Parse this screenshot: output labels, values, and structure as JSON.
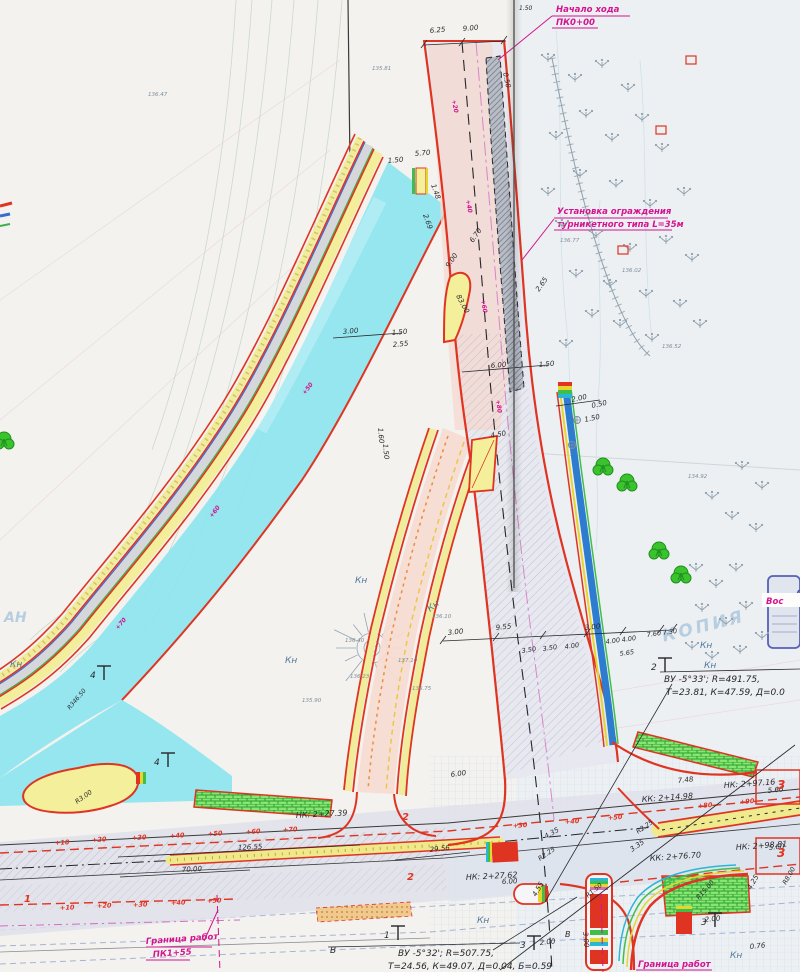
{
  "document": {
    "kind": "road construction plan scan",
    "watermark": "КОПИЯ",
    "corner_mark": "АН"
  },
  "callouts": {
    "start": {
      "line1": "Начало хода",
      "line2": "ПК0+00"
    },
    "fence": {
      "line1": "Установка ограждения",
      "line2": "турникетного типа L=35м"
    },
    "boundary_left": {
      "line1": "Граница работ",
      "line2": "ПК1+55"
    },
    "boundary_right": {
      "line1": "Граница работ"
    },
    "vos": "Вос"
  },
  "curves": {
    "c1": {
      "line1": "ВУ -5°33'; R=491.75,",
      "line2": "Т=23.81, К=47.59, Д=0.0"
    },
    "c2": {
      "line1": "ВУ -5°32'; R=507.75,",
      "line2": "Т=24.56, К=49.07, Д=0.04, Б=0.59"
    }
  },
  "colors": {
    "curb_red": "#e03422",
    "magenta": "#d4148f",
    "cyan_road": "#8ce4ef",
    "yellow_walk": "#f2ee9b",
    "drain_blue": "#2e7cd0",
    "lawn_green": "#86e573"
  },
  "labels": [
    {
      "t": "НК: 2+27.39",
      "x": 296,
      "y": 818,
      "r": -3,
      "c": "k",
      "s": 8,
      "n": "station-label"
    },
    {
      "t": "НК: 2+27.62",
      "x": 466,
      "y": 880,
      "r": -3,
      "c": "k",
      "s": 8,
      "n": "station-label"
    },
    {
      "t": "КК: 2+14.98",
      "x": 642,
      "y": 802,
      "r": -4,
      "c": "k",
      "s": 8,
      "n": "station-label"
    },
    {
      "t": "НК: 2+97.16",
      "x": 724,
      "y": 788,
      "r": -4,
      "c": "k",
      "s": 8,
      "n": "station-label"
    },
    {
      "t": "НК: 2+98.81",
      "x": 736,
      "y": 850,
      "r": -4,
      "c": "k",
      "s": 8,
      "n": "station-label"
    },
    {
      "t": "КК: 2+76.70",
      "x": 650,
      "y": 861,
      "r": -4,
      "c": "k",
      "s": 8,
      "n": "station-label"
    },
    {
      "t": "6.25",
      "x": 430,
      "y": 33,
      "r": -5,
      "c": "k",
      "s": 7
    },
    {
      "t": "9.00",
      "x": 463,
      "y": 31,
      "r": -5,
      "c": "k",
      "s": 7
    },
    {
      "t": "0.50",
      "x": 503,
      "y": 73,
      "r": 78,
      "c": "k",
      "s": 7
    },
    {
      "t": "1.50",
      "x": 519,
      "y": 10,
      "r": 0,
      "c": "k",
      "s": 6
    },
    {
      "t": "5.70",
      "x": 415,
      "y": 156,
      "r": -5,
      "c": "k",
      "s": 7
    },
    {
      "t": "1.50",
      "x": 388,
      "y": 163,
      "r": -5,
      "c": "k",
      "s": 7
    },
    {
      "t": "1.48",
      "x": 431,
      "y": 185,
      "r": 70,
      "c": "k",
      "s": 7
    },
    {
      "t": "2.69",
      "x": 423,
      "y": 215,
      "r": 70,
      "c": "k",
      "s": 7
    },
    {
      "t": "6.70",
      "x": 473,
      "y": 243,
      "r": -55,
      "c": "k",
      "s": 7
    },
    {
      "t": "9.00",
      "x": 449,
      "y": 268,
      "r": -55,
      "c": "k",
      "s": 7
    },
    {
      "t": "83.00",
      "x": 456,
      "y": 296,
      "r": 62,
      "c": "k",
      "s": 7
    },
    {
      "t": "2.65",
      "x": 539,
      "y": 292,
      "r": -55,
      "c": "k",
      "s": 7
    },
    {
      "t": "6.00",
      "x": 491,
      "y": 368,
      "r": -5,
      "c": "k",
      "s": 7
    },
    {
      "t": "1.50",
      "x": 539,
      "y": 367,
      "r": -5,
      "c": "k",
      "s": 7
    },
    {
      "t": "3.00",
      "x": 343,
      "y": 334,
      "r": -5,
      "c": "k",
      "s": 7
    },
    {
      "t": "1.50",
      "x": 392,
      "y": 335,
      "r": -5,
      "c": "k",
      "s": 7
    },
    {
      "t": "2.55",
      "x": 393,
      "y": 347,
      "r": -5,
      "c": "k",
      "s": 7
    },
    {
      "t": "2.00",
      "x": 572,
      "y": 402,
      "r": -12,
      "c": "k",
      "s": 7
    },
    {
      "t": "0.50",
      "x": 592,
      "y": 408,
      "r": -12,
      "c": "k",
      "s": 7
    },
    {
      "t": "1.50",
      "x": 585,
      "y": 422,
      "r": -12,
      "c": "k",
      "s": 7
    },
    {
      "t": "1.60",
      "x": 378,
      "y": 428,
      "r": 85,
      "c": "k",
      "s": 7
    },
    {
      "t": "1.50",
      "x": 383,
      "y": 444,
      "r": 85,
      "c": "k",
      "s": 7
    },
    {
      "t": "4.50",
      "x": 491,
      "y": 438,
      "r": -10,
      "c": "k",
      "s": 7
    },
    {
      "t": "3.00",
      "x": 448,
      "y": 635,
      "r": -6,
      "c": "k",
      "s": 7
    },
    {
      "t": "9.55",
      "x": 496,
      "y": 630,
      "r": -6,
      "c": "k",
      "s": 7
    },
    {
      "t": "3.00",
      "x": 585,
      "y": 630,
      "r": -6,
      "c": "k",
      "s": 7
    },
    {
      "t": "3.50",
      "x": 522,
      "y": 653,
      "r": -8,
      "c": "k",
      "s": 6.5
    },
    {
      "t": "3.50",
      "x": 543,
      "y": 651,
      "r": -8,
      "c": "k",
      "s": 6.5
    },
    {
      "t": "4.00",
      "x": 565,
      "y": 649,
      "r": -8,
      "c": "k",
      "s": 6.5
    },
    {
      "t": "4.00",
      "x": 606,
      "y": 644,
      "r": -8,
      "c": "k",
      "s": 6.5
    },
    {
      "t": "4.00",
      "x": 622,
      "y": 642,
      "r": -8,
      "c": "k",
      "s": 6.5
    },
    {
      "t": "7.60",
      "x": 647,
      "y": 637,
      "r": -8,
      "c": "k",
      "s": 6.5
    },
    {
      "t": "7.50",
      "x": 663,
      "y": 635,
      "r": -8,
      "c": "k",
      "s": 6.5
    },
    {
      "t": "5.65",
      "x": 620,
      "y": 656,
      "r": -8,
      "c": "k",
      "s": 6.5
    },
    {
      "t": "6.00",
      "x": 451,
      "y": 777,
      "r": -8,
      "c": "k",
      "s": 7
    },
    {
      "t": "126.55",
      "x": 238,
      "y": 850,
      "r": -3,
      "c": "k",
      "s": 7
    },
    {
      "t": "70.00",
      "x": 182,
      "y": 872,
      "r": -3,
      "c": "k",
      "s": 7
    },
    {
      "t": "29.56",
      "x": 430,
      "y": 852,
      "r": -6,
      "c": "k",
      "s": 7
    },
    {
      "t": "6.00",
      "x": 502,
      "y": 884,
      "r": -3,
      "c": "k",
      "s": 7
    },
    {
      "t": "4.35",
      "x": 546,
      "y": 839,
      "r": -30,
      "c": "k",
      "s": 7
    },
    {
      "t": "R2.25",
      "x": 540,
      "y": 861,
      "r": -35,
      "c": "k",
      "s": 6.5
    },
    {
      "t": "3.35",
      "x": 632,
      "y": 852,
      "r": -35,
      "c": "k",
      "s": 7
    },
    {
      "t": "R2.25",
      "x": 638,
      "y": 834,
      "r": -35,
      "c": "k",
      "s": 6.5
    },
    {
      "t": "7.48",
      "x": 678,
      "y": 783,
      "r": -6,
      "c": "k",
      "s": 7
    },
    {
      "t": "5.60",
      "x": 768,
      "y": 793,
      "r": -6,
      "c": "k",
      "s": 7
    },
    {
      "t": "5.60",
      "x": 769,
      "y": 850,
      "r": -6,
      "c": "k",
      "s": 7
    },
    {
      "t": "4.25",
      "x": 751,
      "y": 890,
      "r": -60,
      "c": "k",
      "s": 7
    },
    {
      "t": "R8.00",
      "x": 786,
      "y": 885,
      "r": -60,
      "c": "k",
      "s": 6.5
    },
    {
      "t": "2.00",
      "x": 705,
      "y": 922,
      "r": -6,
      "c": "k",
      "s": 7
    },
    {
      "t": "0.76",
      "x": 750,
      "y": 949,
      "r": -6,
      "c": "k",
      "s": 7
    },
    {
      "t": "R15.00",
      "x": 699,
      "y": 900,
      "r": -48,
      "c": "k",
      "s": 6.5
    },
    {
      "t": "R1.50",
      "x": 588,
      "y": 898,
      "r": -40,
      "c": "k",
      "s": 6.5
    },
    {
      "t": "4.55",
      "x": 536,
      "y": 897,
      "r": -60,
      "c": "k",
      "s": 7
    },
    {
      "t": "3.00",
      "x": 583,
      "y": 932,
      "r": 85,
      "c": "k",
      "s": 7
    },
    {
      "t": "2.00",
      "x": 540,
      "y": 945,
      "r": -6,
      "c": "k",
      "s": 7
    },
    {
      "t": "R3.00",
      "x": 77,
      "y": 804,
      "r": -35,
      "c": "k",
      "s": 6.5
    },
    {
      "t": "R346.50",
      "x": 70,
      "y": 710,
      "r": -50,
      "c": "k",
      "s": 6
    },
    {
      "t": "В",
      "x": 330,
      "y": 953,
      "r": 0,
      "c": "k",
      "s": 9
    },
    {
      "t": "В",
      "x": 565,
      "y": 937,
      "r": 0,
      "c": "k",
      "s": 8
    },
    {
      "t": "Кн",
      "x": 10,
      "y": 667,
      "r": 0,
      "c": "b",
      "s": 9,
      "n": "kn-label"
    },
    {
      "t": "Кн",
      "x": 285,
      "y": 663,
      "r": 0,
      "c": "b",
      "s": 9,
      "n": "kn-label"
    },
    {
      "t": "Кн",
      "x": 355,
      "y": 583,
      "r": 0,
      "c": "b",
      "s": 9,
      "n": "kn-label"
    },
    {
      "t": "Кн",
      "x": 430,
      "y": 612,
      "r": -38,
      "c": "b",
      "s": 9,
      "n": "kn-label"
    },
    {
      "t": "Кн",
      "x": 700,
      "y": 648,
      "r": 0,
      "c": "b",
      "s": 9,
      "n": "kn-label"
    },
    {
      "t": "Кн",
      "x": 704,
      "y": 668,
      "r": 0,
      "c": "b",
      "s": 9,
      "n": "kn-label"
    },
    {
      "t": "Кн",
      "x": 477,
      "y": 923,
      "r": 0,
      "c": "b",
      "s": 9,
      "n": "kn-label"
    },
    {
      "t": "Кн",
      "x": 730,
      "y": 958,
      "r": 0,
      "c": "b",
      "s": 9,
      "n": "kn-label"
    },
    {
      "t": "+10",
      "x": 55,
      "y": 845,
      "r": -3,
      "c": "r",
      "s": 6.5
    },
    {
      "t": "+20",
      "x": 92,
      "y": 842,
      "r": -3,
      "c": "r",
      "s": 6.5
    },
    {
      "t": "+30",
      "x": 132,
      "y": 840,
      "r": -3,
      "c": "r",
      "s": 6.5
    },
    {
      "t": "+40",
      "x": 170,
      "y": 838,
      "r": -3,
      "c": "r",
      "s": 6.5
    },
    {
      "t": "+50",
      "x": 208,
      "y": 836,
      "r": -3,
      "c": "r",
      "s": 6.5
    },
    {
      "t": "+60",
      "x": 246,
      "y": 834,
      "r": -3,
      "c": "r",
      "s": 6.5
    },
    {
      "t": "+70",
      "x": 283,
      "y": 832,
      "r": -3,
      "c": "r",
      "s": 6.5
    },
    {
      "t": "+30",
      "x": 513,
      "y": 828,
      "r": -4,
      "c": "r",
      "s": 6.5
    },
    {
      "t": "+40",
      "x": 565,
      "y": 824,
      "r": -4,
      "c": "r",
      "s": 6.5
    },
    {
      "t": "+50",
      "x": 608,
      "y": 820,
      "r": -4,
      "c": "r",
      "s": 6.5
    },
    {
      "t": "+80",
      "x": 698,
      "y": 808,
      "r": -4,
      "c": "r",
      "s": 6.5
    },
    {
      "t": "+90",
      "x": 740,
      "y": 804,
      "r": -4,
      "c": "r",
      "s": 6.5
    },
    {
      "t": "+10",
      "x": 60,
      "y": 910,
      "r": -2,
      "c": "r",
      "s": 6.5
    },
    {
      "t": "+20",
      "x": 97,
      "y": 908,
      "r": -2,
      "c": "r",
      "s": 6.5
    },
    {
      "t": "+30",
      "x": 133,
      "y": 907,
      "r": -2,
      "c": "r",
      "s": 6.5
    },
    {
      "t": "+40",
      "x": 171,
      "y": 905,
      "r": -2,
      "c": "r",
      "s": 6.5
    },
    {
      "t": "+50",
      "x": 207,
      "y": 903,
      "r": -2,
      "c": "r",
      "s": 6.5
    },
    {
      "t": "1",
      "x": 24,
      "y": 902,
      "r": 0,
      "c": "r",
      "s": 10,
      "n": "zone-number"
    },
    {
      "t": "2",
      "x": 402,
      "y": 820,
      "r": 0,
      "c": "r",
      "s": 10,
      "n": "zone-number"
    },
    {
      "t": "2",
      "x": 407,
      "y": 880,
      "r": 0,
      "c": "r",
      "s": 10,
      "n": "zone-number"
    },
    {
      "t": "3",
      "x": 777,
      "y": 789,
      "r": 0,
      "c": "r",
      "s": 12,
      "n": "zone-number"
    },
    {
      "t": "3",
      "x": 777,
      "y": 857,
      "r": 0,
      "c": "r",
      "s": 12,
      "n": "zone-number"
    },
    {
      "t": "+20",
      "x": 452,
      "y": 100,
      "r": 80,
      "c": "m",
      "s": 6
    },
    {
      "t": "+40",
      "x": 466,
      "y": 200,
      "r": 80,
      "c": "m",
      "s": 6
    },
    {
      "t": "+60",
      "x": 481,
      "y": 300,
      "r": 80,
      "c": "m",
      "s": 6
    },
    {
      "t": "+80",
      "x": 496,
      "y": 400,
      "r": 82,
      "c": "m",
      "s": 6
    },
    {
      "t": "+50",
      "x": 305,
      "y": 395,
      "r": -52,
      "c": "m",
      "s": 6
    },
    {
      "t": "+60",
      "x": 212,
      "y": 518,
      "r": -52,
      "c": "m",
      "s": 6
    },
    {
      "t": "+70",
      "x": 118,
      "y": 630,
      "r": -50,
      "c": "m",
      "s": 6
    },
    {
      "t": "136.47",
      "x": 148,
      "y": 96,
      "r": 0,
      "c": "g",
      "s": 5.5,
      "n": "elevation-label"
    },
    {
      "t": "135.81",
      "x": 372,
      "y": 70,
      "r": 0,
      "c": "g",
      "s": 5.5,
      "n": "elevation-label"
    },
    {
      "t": "136.77",
      "x": 560,
      "y": 242,
      "r": 0,
      "c": "g",
      "s": 5.5,
      "n": "elevation-label"
    },
    {
      "t": "136.02",
      "x": 622,
      "y": 272,
      "r": 0,
      "c": "g",
      "s": 5.5,
      "n": "elevation-label"
    },
    {
      "t": "136.52",
      "x": 662,
      "y": 348,
      "r": 0,
      "c": "g",
      "s": 5.5,
      "n": "elevation-label"
    },
    {
      "t": "134.92",
      "x": 688,
      "y": 478,
      "r": 0,
      "c": "g",
      "s": 5.5,
      "n": "elevation-label"
    },
    {
      "t": "136.40",
      "x": 345,
      "y": 642,
      "r": 0,
      "c": "g",
      "s": 5.5,
      "n": "elevation-label"
    },
    {
      "t": "137.10",
      "x": 398,
      "y": 662,
      "r": 0,
      "c": "g",
      "s": 5.5,
      "n": "elevation-label"
    },
    {
      "t": "136.75",
      "x": 412,
      "y": 690,
      "r": 0,
      "c": "g",
      "s": 5.5,
      "n": "elevation-label"
    },
    {
      "t": "135.90",
      "x": 302,
      "y": 702,
      "r": 0,
      "c": "g",
      "s": 5.5,
      "n": "elevation-label"
    },
    {
      "t": "136.10",
      "x": 432,
      "y": 618,
      "r": 0,
      "c": "g",
      "s": 5.5,
      "n": "elevation-label"
    },
    {
      "t": "136.23",
      "x": 350,
      "y": 678,
      "r": 0,
      "c": "g",
      "s": 5.5,
      "n": "elevation-label"
    }
  ],
  "flags": [
    {
      "n": "1",
      "x": 388,
      "y": 940
    },
    {
      "n": "2",
      "x": 655,
      "y": 672
    },
    {
      "n": "3",
      "x": 705,
      "y": 927
    },
    {
      "n": "3",
      "x": 524,
      "y": 950
    },
    {
      "n": "4",
      "x": 94,
      "y": 680
    },
    {
      "n": "4",
      "x": 158,
      "y": 767
    }
  ],
  "trees": [
    {
      "x": 603,
      "y": 467
    },
    {
      "x": 627,
      "y": 483
    },
    {
      "x": 659,
      "y": 551
    },
    {
      "x": 681,
      "y": 575
    },
    {
      "x": 4,
      "y": 441
    }
  ],
  "bushes": [
    {
      "x": 548,
      "y": 62
    },
    {
      "x": 575,
      "y": 82
    },
    {
      "x": 602,
      "y": 68
    },
    {
      "x": 628,
      "y": 92
    },
    {
      "x": 586,
      "y": 118
    },
    {
      "x": 556,
      "y": 140
    },
    {
      "x": 612,
      "y": 142
    },
    {
      "x": 642,
      "y": 122
    },
    {
      "x": 662,
      "y": 152
    },
    {
      "x": 580,
      "y": 178
    },
    {
      "x": 548,
      "y": 196
    },
    {
      "x": 616,
      "y": 188
    },
    {
      "x": 650,
      "y": 208
    },
    {
      "x": 684,
      "y": 196
    },
    {
      "x": 562,
      "y": 228
    },
    {
      "x": 596,
      "y": 238
    },
    {
      "x": 630,
      "y": 252
    },
    {
      "x": 666,
      "y": 244
    },
    {
      "x": 692,
      "y": 262
    },
    {
      "x": 576,
      "y": 278
    },
    {
      "x": 610,
      "y": 288
    },
    {
      "x": 646,
      "y": 298
    },
    {
      "x": 680,
      "y": 308
    },
    {
      "x": 700,
      "y": 328
    },
    {
      "x": 620,
      "y": 328
    },
    {
      "x": 592,
      "y": 318
    },
    {
      "x": 652,
      "y": 342
    },
    {
      "x": 566,
      "y": 348
    },
    {
      "x": 742,
      "y": 470
    },
    {
      "x": 762,
      "y": 490
    },
    {
      "x": 712,
      "y": 500
    },
    {
      "x": 732,
      "y": 520
    },
    {
      "x": 756,
      "y": 532
    },
    {
      "x": 696,
      "y": 572
    },
    {
      "x": 716,
      "y": 588
    },
    {
      "x": 736,
      "y": 572
    },
    {
      "x": 702,
      "y": 612
    },
    {
      "x": 726,
      "y": 626
    },
    {
      "x": 746,
      "y": 610
    },
    {
      "x": 762,
      "y": 640
    },
    {
      "x": 692,
      "y": 650
    },
    {
      "x": 712,
      "y": 660
    },
    {
      "x": 740,
      "y": 654
    }
  ],
  "red_boxes": [
    {
      "x": 686,
      "y": 56
    },
    {
      "x": 656,
      "y": 126
    },
    {
      "x": 618,
      "y": 246
    }
  ],
  "wells": [
    {
      "x": 577,
      "y": 420
    },
    {
      "x": 572,
      "y": 445
    }
  ]
}
